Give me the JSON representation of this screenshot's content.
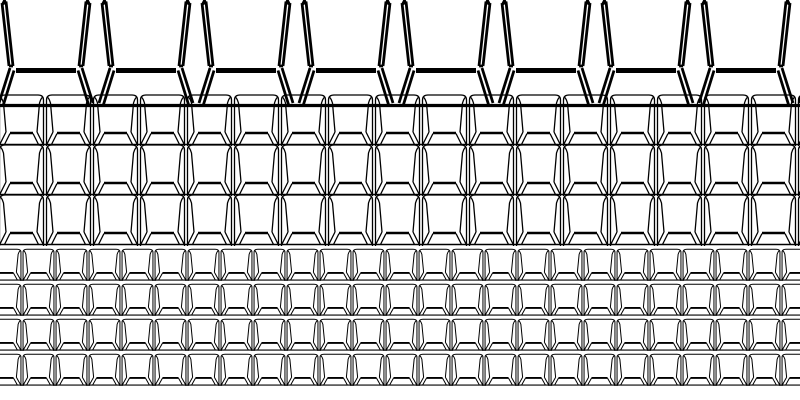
{
  "canvas": {
    "width": 800,
    "height": 400,
    "background_color": "#ffffff",
    "line_color": "#000000"
  },
  "pattern": {
    "description": "Repeating black wireframe open-box (tray) glyphs tiled across a white canvas in three size bands: one large heavy-stroke open-top row cut by the top edge, three rows of medium rounded-top units, and four rows of small rounded-top units. Each unit has doubled side walls that lean slightly inward, a thick horizontal floor bar, doubled 45-degree bevel wedges flaring to the outer bottom corners, and a thin base line that merges with its neighbors.",
    "bands": [
      {
        "name": "large-open-trays",
        "variant": "open-top",
        "unit_width": 100,
        "unit_height": 107,
        "start_x": -4,
        "pitch_x": 100,
        "columns": 9,
        "row_tops": [
          0
        ],
        "stroke_width": 2.8,
        "bar_stroke_width": 5.0,
        "base_stroke_width": 3.2
      },
      {
        "name": "medium-round-top-trays",
        "variant": "rounded-top",
        "unit_width": 47,
        "unit_height": 53,
        "start_x": -2,
        "pitch_x": 47,
        "columns": 18,
        "row_tops": [
          93,
          143,
          193
        ],
        "stroke_width": 1.3,
        "bar_stroke_width": 2.4,
        "base_stroke_width": 1.5
      },
      {
        "name": "small-round-top-trays",
        "variant": "rounded-top",
        "unit_width": 33,
        "unit_height": 33,
        "start_x": -11,
        "pitch_x": 33,
        "columns": 25,
        "row_tops": [
          248,
          283,
          318,
          353
        ],
        "stroke_width": 1.0,
        "bar_stroke_width": 1.9,
        "base_stroke_width": 1.2
      }
    ]
  }
}
